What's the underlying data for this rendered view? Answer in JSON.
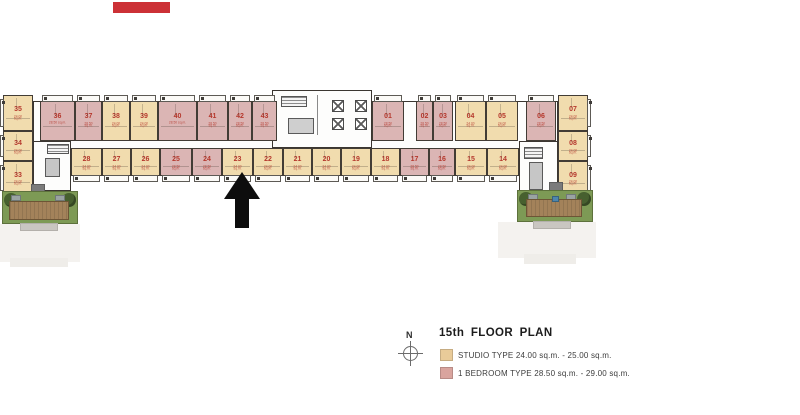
{
  "header": {
    "logo_color": "#cc3136"
  },
  "legend": {
    "north_label": "N",
    "title": "15th FLOOR PLAN",
    "items": [
      {
        "color": "#e9cb99",
        "label": "STUDIO TYPE 24.00 sq.m. - 25.00 sq.m."
      },
      {
        "color": "#d9a49e",
        "label": "1 BEDROOM TYPE 28.50 sq.m. - 29.00 sq.m."
      }
    ]
  },
  "plan": {
    "colors": {
      "studio": "#f1dcae",
      "one_bedroom": "#dbb5b4",
      "wall": "#3b3631",
      "number": "#b5372c",
      "garden": "#7d9a55",
      "deck": "#a3825a",
      "bush": "#47602f",
      "pool_dot": "#4f86ac"
    },
    "area_labels": {
      "studio": "24.00 sq.m.",
      "one_bedroom": "28.50 sq.m."
    },
    "highlighted_unit": "23",
    "top_row": [
      {
        "no": "36",
        "type": "one_bedroom",
        "x": 40,
        "w": 35
      },
      {
        "no": "37",
        "type": "one_bedroom",
        "x": 75,
        "w": 27
      },
      {
        "no": "38",
        "type": "studio",
        "x": 102,
        "w": 28
      },
      {
        "no": "39",
        "type": "studio",
        "x": 130,
        "w": 28
      },
      {
        "no": "40",
        "type": "one_bedroom",
        "x": 158,
        "w": 39
      },
      {
        "no": "41",
        "type": "one_bedroom",
        "x": 197,
        "w": 31
      },
      {
        "no": "42",
        "type": "one_bedroom",
        "x": 228,
        "w": 24
      },
      {
        "no": "43",
        "type": "one_bedroom",
        "x": 252,
        "w": 25
      },
      {
        "no": "01",
        "type": "one_bedroom",
        "x": 372,
        "w": 32
      },
      {
        "no": "02",
        "type": "one_bedroom",
        "x": 416,
        "w": 17
      },
      {
        "no": "03",
        "type": "one_bedroom",
        "x": 433,
        "w": 20
      },
      {
        "no": "04",
        "type": "studio",
        "x": 455,
        "w": 31
      },
      {
        "no": "05",
        "type": "studio",
        "x": 486,
        "w": 32
      },
      {
        "no": "06",
        "type": "one_bedroom",
        "x": 526,
        "w": 30
      }
    ],
    "bottom_row": [
      {
        "no": "28",
        "type": "studio",
        "x": 71,
        "w": 31
      },
      {
        "no": "27",
        "type": "studio",
        "x": 102,
        "w": 29
      },
      {
        "no": "26",
        "type": "studio",
        "x": 131,
        "w": 29
      },
      {
        "no": "25",
        "type": "one_bedroom",
        "x": 160,
        "w": 32
      },
      {
        "no": "24",
        "type": "one_bedroom",
        "x": 192,
        "w": 30
      },
      {
        "no": "23",
        "type": "studio",
        "x": 222,
        "w": 31
      },
      {
        "no": "22",
        "type": "studio",
        "x": 253,
        "w": 30
      },
      {
        "no": "21",
        "type": "studio",
        "x": 283,
        "w": 29
      },
      {
        "no": "20",
        "type": "studio",
        "x": 312,
        "w": 29
      },
      {
        "no": "19",
        "type": "studio",
        "x": 341,
        "w": 30
      },
      {
        "no": "18",
        "type": "studio",
        "x": 371,
        "w": 29
      },
      {
        "no": "17",
        "type": "one_bedroom",
        "x": 400,
        "w": 29
      },
      {
        "no": "16",
        "type": "one_bedroom",
        "x": 429,
        "w": 26
      },
      {
        "no": "15",
        "type": "studio",
        "x": 455,
        "w": 32
      },
      {
        "no": "14",
        "type": "studio",
        "x": 487,
        "w": 32
      }
    ],
    "left_column": [
      {
        "no": "35",
        "type": "studio",
        "y": 95,
        "h": 36
      },
      {
        "no": "34",
        "type": "studio",
        "y": 131,
        "h": 30
      },
      {
        "no": "33",
        "type": "studio",
        "y": 161,
        "h": 34
      }
    ],
    "right_column": [
      {
        "no": "07",
        "type": "studio",
        "y": 95,
        "h": 36
      },
      {
        "no": "08",
        "type": "studio",
        "y": 131,
        "h": 30
      },
      {
        "no": "09",
        "type": "studio",
        "y": 161,
        "h": 35
      }
    ]
  }
}
